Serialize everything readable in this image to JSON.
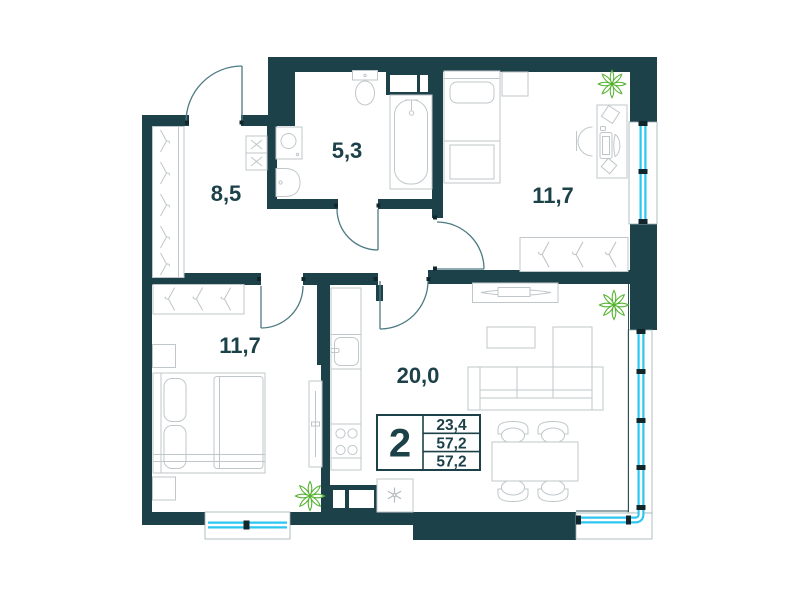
{
  "colors": {
    "wall": "#1d4149",
    "window": "#2cc6f1",
    "furniture": "#c0c7ca",
    "plant": "#56b332",
    "door": "#4e7a83",
    "text": "#1d4149",
    "tick": "#10262b"
  },
  "rooms": [
    {
      "id": "hallway",
      "area": "8,5"
    },
    {
      "id": "bathroom",
      "area": "5,3"
    },
    {
      "id": "bedroom-top",
      "area": "11,7"
    },
    {
      "id": "bedroom-left",
      "area": "11,7"
    },
    {
      "id": "kitchen-living",
      "area": "20,0"
    }
  ],
  "info_box": {
    "rooms_count": "2",
    "areas": [
      "23,4",
      "57,2",
      "57,2"
    ]
  },
  "icons": {
    "plant-icon": "leaf-cluster",
    "snowflake-icon": "snowflake",
    "hanger-icon": "clothes-hanger"
  }
}
